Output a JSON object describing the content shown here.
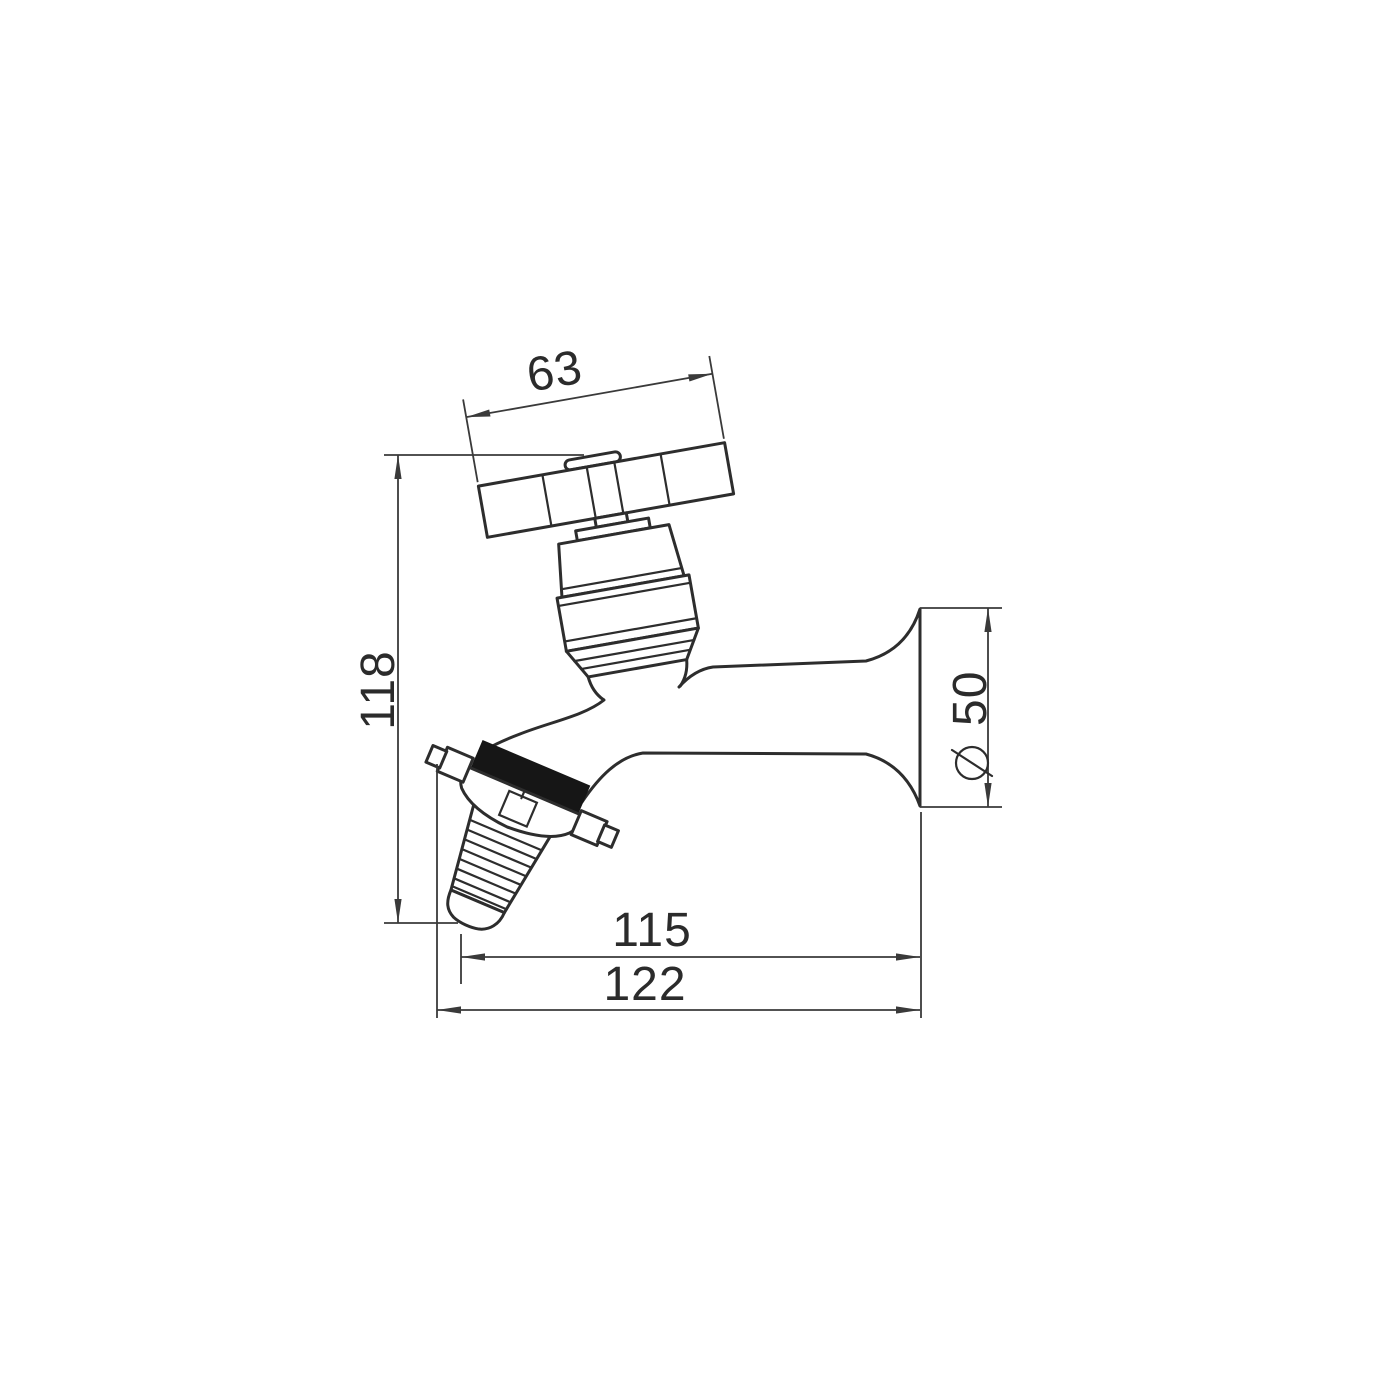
{
  "dimensions": {
    "handle_width": "63",
    "overall_height": "118",
    "flange_diameter": "50",
    "flange_diameter_symbol": "⌀",
    "spout_reach": "115",
    "overall_depth": "122"
  },
  "colors": {
    "line": "#2d2d2d",
    "dimension": "#3a3a3a",
    "solid_band": "#161616",
    "background": "#ffffff"
  }
}
